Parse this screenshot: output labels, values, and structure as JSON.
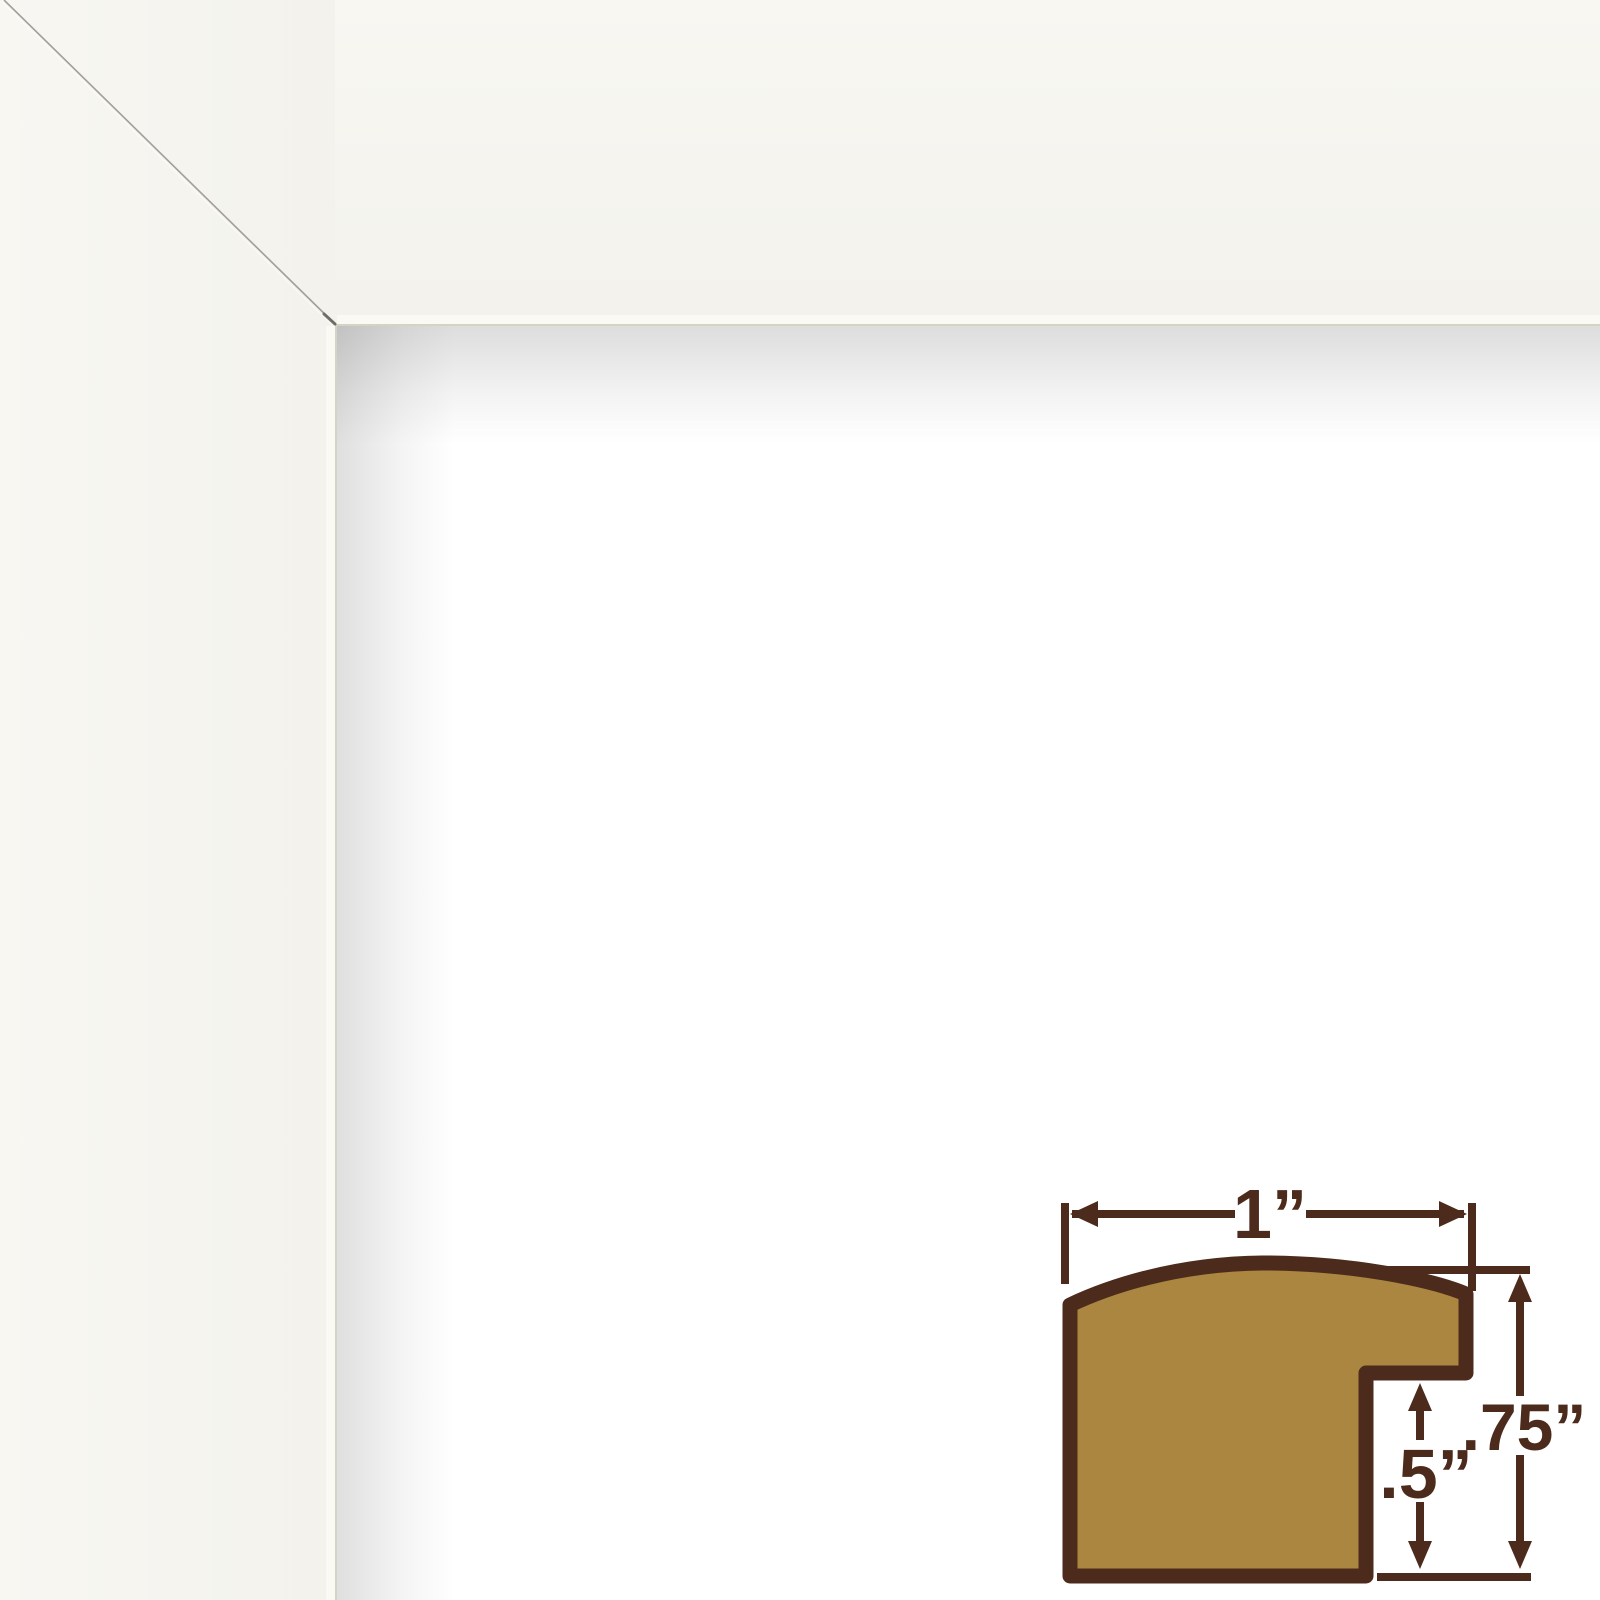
{
  "colors": {
    "page-bg": "#FFFFFF",
    "frame-face": "#F5F4EF",
    "frame-face-light": "#F8F7F2",
    "frame-edge-highlight": "#FAF9F4",
    "frame-edge-line": "#D6D3C4",
    "miter-line": "#93918A",
    "wood-fill": "#AA8641",
    "diagram-brown": "#4D2B1C"
  },
  "diagram": {
    "width_label": "1”",
    "rabbet_depth_label": ".5”",
    "height_label": ".75”"
  }
}
